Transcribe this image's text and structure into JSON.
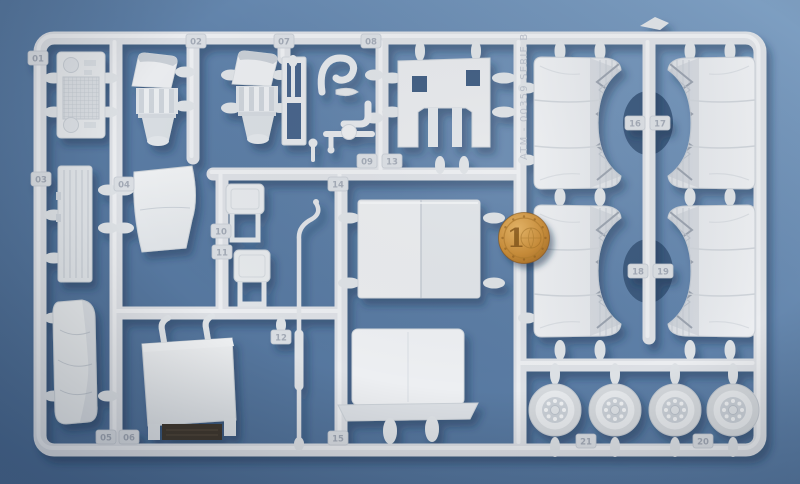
{
  "colors": {
    "background_top_right": "#7fa0c3",
    "background_bottom_left": "#4c6c93",
    "plastic": "#dfe2e6",
    "plastic_highlight": "#eff1f4",
    "cast_shadow": "#16304f",
    "through_hole": "#3b597d",
    "coin_copper": "#c68934",
    "dark_slot": "#3f382e"
  },
  "sprue": {
    "marking": "ATM - 00359 SERIE B",
    "tags": [
      {
        "label": "01"
      },
      {
        "label": "02"
      },
      {
        "label": "03"
      },
      {
        "label": "04"
      },
      {
        "label": "05"
      },
      {
        "label": "06"
      },
      {
        "label": "07"
      },
      {
        "label": "08"
      },
      {
        "label": "09"
      },
      {
        "label": "10"
      },
      {
        "label": "11"
      },
      {
        "label": "12"
      },
      {
        "label": "13"
      },
      {
        "label": "14"
      },
      {
        "label": "15"
      },
      {
        "label": "16"
      },
      {
        "label": "17"
      },
      {
        "label": "18"
      },
      {
        "label": "19"
      },
      {
        "label": "20"
      },
      {
        "label": "21"
      }
    ]
  },
  "coin": {
    "numeral": "1"
  }
}
